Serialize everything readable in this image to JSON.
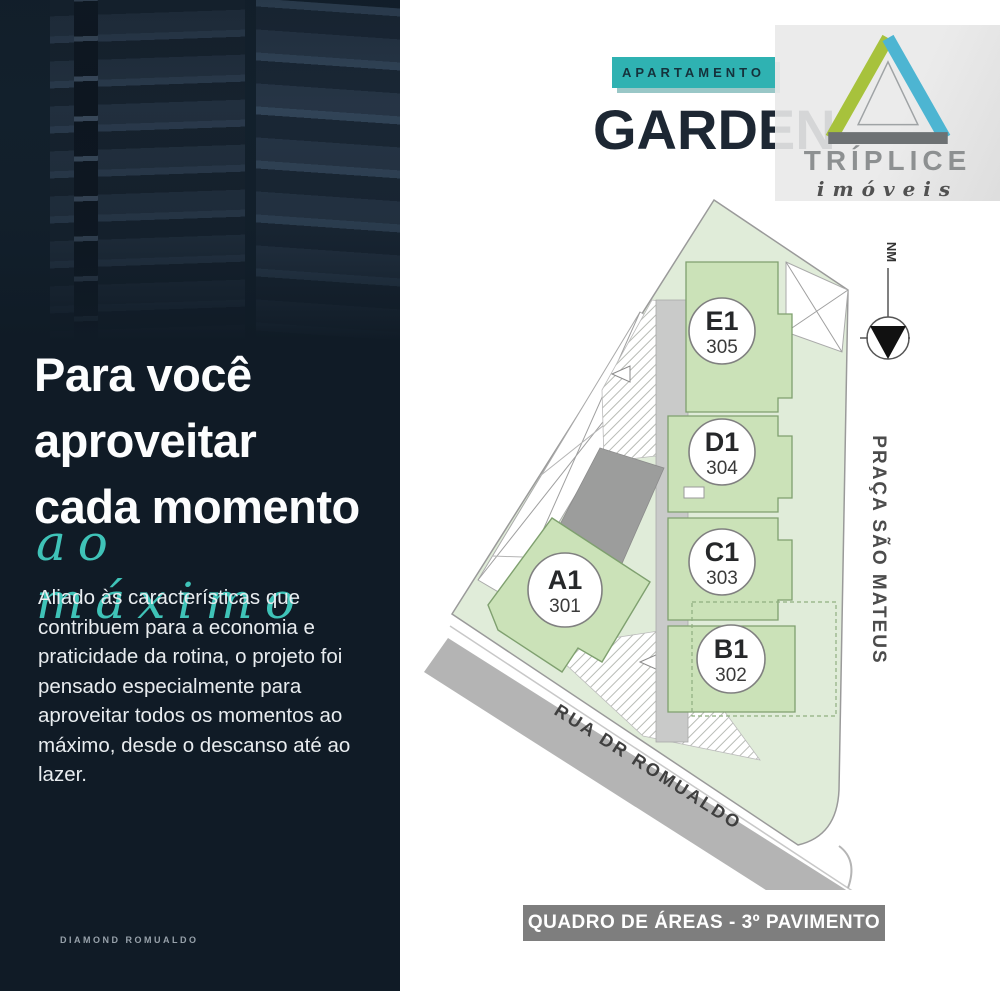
{
  "left_panel": {
    "background": "#101b26",
    "accent": "#3fc3b8",
    "headline_line1": "Para você",
    "headline_line2": "aproveitar",
    "headline_line3": "cada momento",
    "headline_script": "ao máximo",
    "body": "Aliado às características que contribuem para a economia e praticidade da rotina, o projeto foi pensado especialmente para aproveitar todos os momentos ao máximo, desde o descanso até ao lazer.",
    "footer": "DIAMOND ROMUALDO"
  },
  "header": {
    "category_badge": "APARTAMENTO",
    "badge_color": "#2fb2b2",
    "title": "GARDEN",
    "logo": {
      "brand": "TRÍPLICE",
      "tagline": "imóveis",
      "triangle_green": "#a7c23c",
      "triangle_blue": "#4db5d2",
      "triangle_gray": "#6d7173"
    }
  },
  "site_plan": {
    "units": [
      {
        "code": "E1",
        "number": "305"
      },
      {
        "code": "D1",
        "number": "304"
      },
      {
        "code": "C1",
        "number": "303"
      },
      {
        "code": "B1",
        "number": "302"
      },
      {
        "code": "A1",
        "number": "301"
      }
    ],
    "street_label": "RUA DR ROMUALDO",
    "square_label": "PRAÇA SÃO MATEUS",
    "north_marker": "NM",
    "colors": {
      "lot_green": "#e0ecd9",
      "unit_green": "#cbe2b8",
      "core_gray": "#c9cac9",
      "core_dark": "#9c9d9c",
      "street_gray": "#b4b4b4"
    }
  },
  "area_badge": {
    "label": "QUADRO DE ÁREAS - 3º PAVIMENTO",
    "background": "#7e7e7e"
  }
}
